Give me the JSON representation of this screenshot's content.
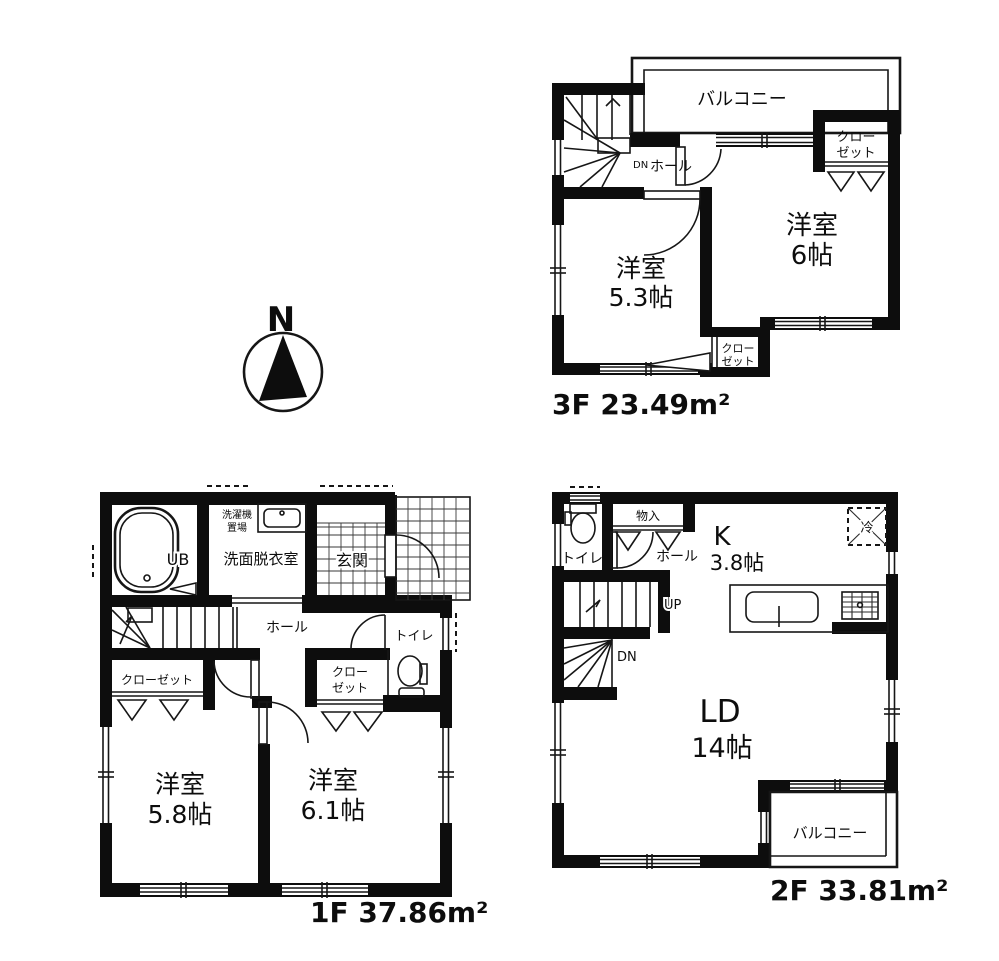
{
  "page": {
    "background": "#ffffff",
    "ink": "#0d0d0d"
  },
  "compass": {
    "north_label": "N"
  },
  "floor_3f": {
    "area_label": "3F 23.49m²",
    "balcony": "バルコニー",
    "closet_top_line1": "クロー",
    "closet_top_line2": "ゼット",
    "stair_down": "DN",
    "hall": "ホール",
    "room_east_name": "洋室",
    "room_east_size": "6帖",
    "room_west_name": "洋室",
    "room_west_size": "5.3帖",
    "closet_bottom_line1": "クロー",
    "closet_bottom_line2": "ゼット"
  },
  "floor_2f": {
    "area_label": "2F 33.81m²",
    "toilet": "トイレ",
    "storage": "物入",
    "hall": "ホール",
    "kitchen_name": "K",
    "kitchen_size": "3.8帖",
    "fridge": "冷",
    "stair_up": "UP",
    "stair_down": "DN",
    "living_name": "LD",
    "living_size": "14帖",
    "balcony": "バルコニー"
  },
  "floor_1f": {
    "area_label": "1F 37.86m²",
    "bath": "UB",
    "laundry_line1": "洗濯機",
    "laundry_line2": "置場",
    "washroom": "洗面脱衣室",
    "entrance": "玄関",
    "hall": "ホール",
    "toilet": "トイレ",
    "closet_west": "クローゼット",
    "closet_east_line1": "クロー",
    "closet_east_line2": "ゼット",
    "room_west_name": "洋室",
    "room_west_size": "5.8帖",
    "room_east_name": "洋室",
    "room_east_size": "6.1帖"
  }
}
